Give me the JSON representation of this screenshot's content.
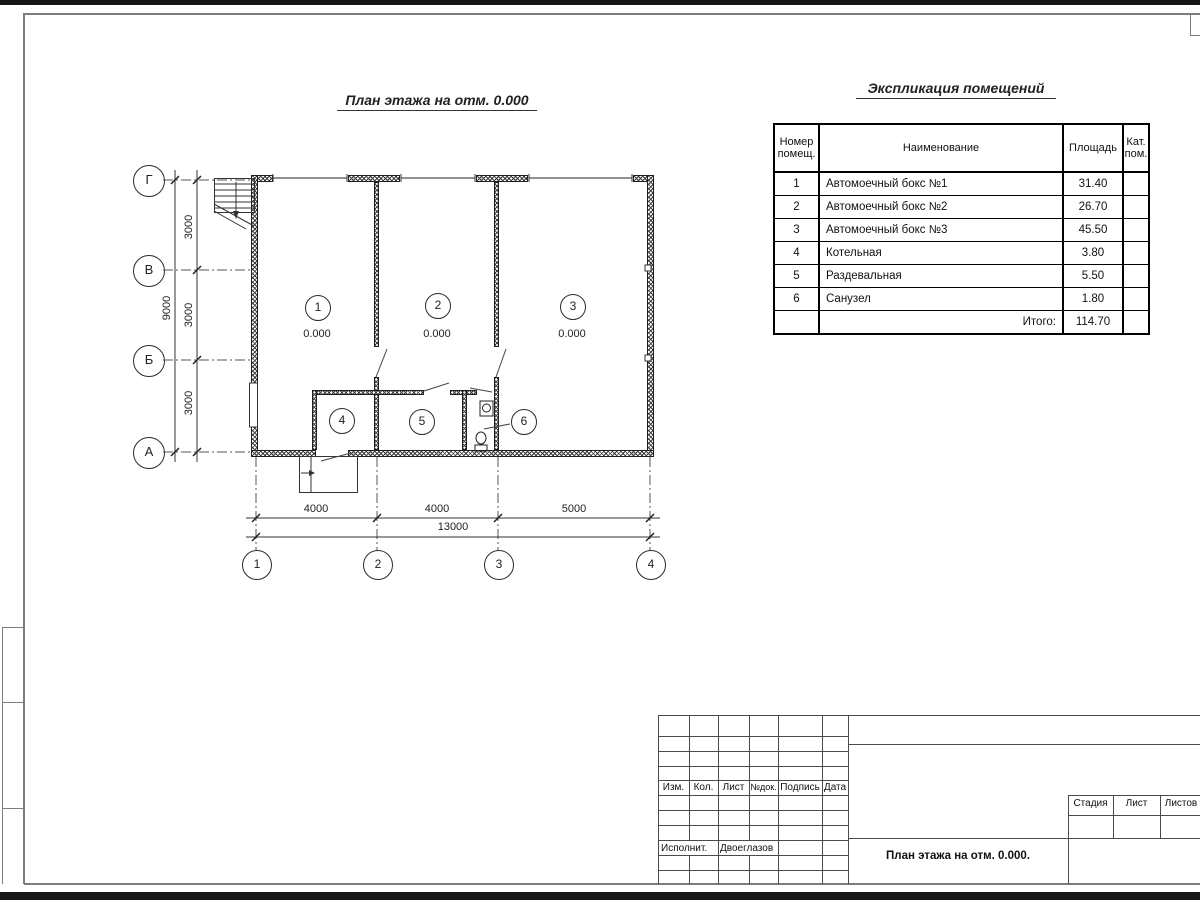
{
  "colors": {
    "line": "#2f2f2f",
    "frame": "#777777"
  },
  "titles": {
    "plan": "План этажа на отм. 0.000",
    "explication": "Экспликация помещений"
  },
  "axes": {
    "left": [
      "Г",
      "В",
      "Б",
      "А"
    ],
    "bottom": [
      "1",
      "2",
      "3",
      "4"
    ]
  },
  "dims": {
    "left_segments": [
      "3000",
      "3000",
      "3000"
    ],
    "left_total": "9000",
    "bottom_segments": [
      "4000",
      "4000",
      "5000"
    ],
    "bottom_total": "13000"
  },
  "rooms": [
    {
      "num": "1",
      "level": "0.000"
    },
    {
      "num": "2",
      "level": "0.000"
    },
    {
      "num": "3",
      "level": "0.000"
    },
    {
      "num": "4"
    },
    {
      "num": "5"
    },
    {
      "num": "6"
    }
  ],
  "explication": {
    "headers": {
      "num_l1": "Номер",
      "num_l2": "помещ.",
      "name": "Наименование",
      "area": "Площадь",
      "cat_l1": "Кат.",
      "cat_l2": "пом."
    },
    "rows": [
      {
        "num": "1",
        "name": "Автомоечный бокс №1",
        "area": "31.40",
        "cat": ""
      },
      {
        "num": "2",
        "name": "Автомоечный бокс №2",
        "area": "26.70",
        "cat": ""
      },
      {
        "num": "3",
        "name": "Автомоечный бокс №3",
        "area": "45.50",
        "cat": ""
      },
      {
        "num": "4",
        "name": "Котельная",
        "area": "3.80",
        "cat": ""
      },
      {
        "num": "5",
        "name": "Раздевальная",
        "area": "5.50",
        "cat": ""
      },
      {
        "num": "6",
        "name": "Санузел",
        "area": "1.80",
        "cat": ""
      }
    ],
    "total_label": "Итого:",
    "total_value": "114.70"
  },
  "title_block": {
    "rev_cols": [
      "Изм.",
      "Кол.",
      "Лист",
      "№док.",
      "Подпись",
      "Дата"
    ],
    "executor_label": "Исполнит.",
    "executor_name": "Двоеглазов",
    "stage_label": "Стадия",
    "sheet_label": "Лист",
    "sheets_label": "Листов",
    "drawing_name": "План этажа на отм. 0.000."
  }
}
